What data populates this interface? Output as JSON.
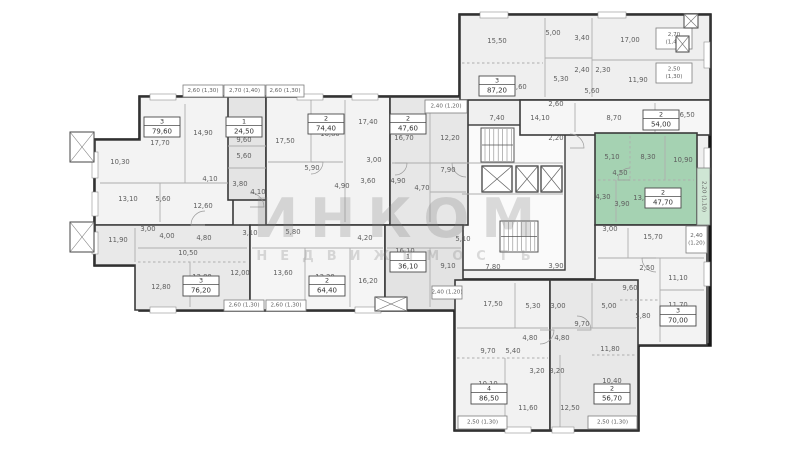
{
  "watermark": {
    "line1": "ИНКОМ",
    "line2": "НЕДВИЖИМОСТЬ"
  },
  "plan": {
    "colors": {
      "floor": "#f0f0f0",
      "wall": "#161616",
      "unit_wall": "#3a3a3a",
      "thin": "#aeaeae",
      "label": "#5f5f5f",
      "tag_border": "#4a4a4a",
      "highlight": "#a5d2b2",
      "highlight_balcony": "#cfe6d4",
      "white": "#ffffff"
    },
    "footprint": [
      [
        140,
        97,
        320,
        213
      ],
      [
        95,
        140,
        50,
        125
      ],
      [
        460,
        15,
        250,
        330
      ],
      [
        455,
        280,
        183,
        150
      ]
    ],
    "core": {
      "rect": [
        460,
        125,
        105,
        145
      ],
      "fill": "#fafafa"
    },
    "units": [
      {
        "id": "79-60",
        "type": "3",
        "area": "79,60",
        "tag": [
          162,
          127
        ],
        "fill": "#f3f3f3",
        "poly": [
          [
            140,
            97
          ],
          [
            233,
            97
          ],
          [
            233,
            225
          ],
          [
            95,
            225
          ],
          [
            95,
            140
          ],
          [
            140,
            140
          ]
        ]
      },
      {
        "id": "24-50",
        "type": "1",
        "area": "24,50",
        "tag": [
          244,
          127
        ],
        "fill": "#e4e4e4",
        "rect": [
          228,
          97,
          38,
          103
        ]
      },
      {
        "id": "74-40",
        "type": "2",
        "area": "74,40",
        "tag": [
          326,
          124
        ],
        "fill": "#f3f3f3",
        "rect": [
          266,
          97,
          124,
          128
        ]
      },
      {
        "id": "47-60",
        "type": "2",
        "area": "47,60",
        "tag": [
          408,
          124
        ],
        "fill": "#e7e7e7",
        "rect": [
          390,
          97,
          78,
          128
        ]
      },
      {
        "id": "87-20",
        "type": "3",
        "area": "87,20",
        "tag": [
          497,
          86
        ],
        "fill": "#efefef",
        "rect": [
          460,
          15,
          250,
          85
        ]
      },
      {
        "id": "54-00",
        "type": "2",
        "area": "54,00",
        "tag": [
          661,
          120
        ],
        "fill": "#f6f6f6",
        "rect": [
          520,
          100,
          190,
          35
        ]
      },
      {
        "id": "47-70",
        "type": "2",
        "area": "47,70",
        "tag": [
          663,
          198
        ],
        "fill": "#a5d2b2",
        "rect": [
          595,
          133,
          102,
          92
        ],
        "selected": true
      },
      {
        "id": "70-00",
        "type": "3",
        "area": "70,00",
        "tag": [
          678,
          316
        ],
        "fill": "#f3f3f3",
        "rect": [
          595,
          225,
          112,
          120
        ]
      },
      {
        "id": "76-20",
        "type": "3",
        "area": "76,20",
        "tag": [
          201,
          286
        ],
        "fill": "#e9e9e9",
        "poly": [
          [
            95,
            225
          ],
          [
            250,
            225
          ],
          [
            250,
            310
          ],
          [
            135,
            310
          ],
          [
            135,
            265
          ],
          [
            95,
            265
          ]
        ]
      },
      {
        "id": "64-40",
        "type": "2",
        "area": "64,40",
        "tag": [
          327,
          286
        ],
        "fill": "#f5f5f5",
        "rect": [
          250,
          225,
          135,
          85
        ]
      },
      {
        "id": "36-10",
        "type": "1",
        "area": "36,10",
        "tag": [
          408,
          262
        ],
        "fill": "#e3e3e3",
        "rect": [
          385,
          225,
          78,
          85
        ]
      },
      {
        "id": "86-50",
        "type": "4",
        "area": "86,50",
        "tag": [
          489,
          394
        ],
        "fill": "#f2f2f2",
        "rect": [
          455,
          280,
          95,
          150
        ]
      },
      {
        "id": "56-70",
        "type": "2",
        "area": "56,70",
        "tag": [
          612,
          394
        ],
        "fill": "#e8e8e8",
        "rect": [
          550,
          280,
          88,
          150
        ]
      }
    ],
    "lines": [
      [
        185,
        104,
        185,
        183,
        0
      ],
      [
        100,
        183,
        228,
        183,
        0
      ],
      [
        160,
        183,
        160,
        222,
        0
      ],
      [
        228,
        146,
        266,
        146,
        0
      ],
      [
        228,
        168,
        266,
        168,
        0
      ],
      [
        311,
        100,
        311,
        162,
        0
      ],
      [
        268,
        162,
        343,
        162,
        0
      ],
      [
        345,
        100,
        345,
        222,
        0
      ],
      [
        430,
        100,
        430,
        222,
        0
      ],
      [
        392,
        163,
        466,
        163,
        0
      ],
      [
        430,
        192,
        466,
        192,
        0
      ],
      [
        545,
        18,
        545,
        97,
        0
      ],
      [
        462,
        63,
        543,
        63,
        1
      ],
      [
        592,
        18,
        592,
        97,
        0
      ],
      [
        592,
        60,
        708,
        60,
        0
      ],
      [
        545,
        58,
        592,
        58,
        0
      ],
      [
        575,
        103,
        575,
        132,
        0
      ],
      [
        655,
        103,
        655,
        132,
        0
      ],
      [
        630,
        136,
        630,
        180,
        1
      ],
      [
        665,
        136,
        665,
        180,
        0
      ],
      [
        598,
        180,
        694,
        180,
        1
      ],
      [
        616,
        180,
        616,
        222,
        0
      ],
      [
        628,
        228,
        628,
        258,
        0
      ],
      [
        598,
        258,
        704,
        258,
        0
      ],
      [
        660,
        258,
        660,
        342,
        0
      ],
      [
        660,
        290,
        704,
        290,
        0
      ],
      [
        620,
        300,
        660,
        300,
        1
      ],
      [
        135,
        228,
        135,
        262,
        0
      ],
      [
        138,
        248,
        247,
        248,
        0
      ],
      [
        190,
        262,
        190,
        307,
        0
      ],
      [
        138,
        262,
        247,
        262,
        1
      ],
      [
        252,
        248,
        383,
        248,
        0
      ],
      [
        305,
        248,
        305,
        307,
        0
      ],
      [
        350,
        248,
        350,
        307,
        0
      ],
      [
        387,
        248,
        461,
        248,
        0
      ],
      [
        430,
        248,
        430,
        307,
        0
      ],
      [
        515,
        283,
        515,
        328,
        0
      ],
      [
        457,
        328,
        548,
        328,
        0
      ],
      [
        457,
        358,
        548,
        358,
        1
      ],
      [
        505,
        358,
        505,
        428,
        0
      ],
      [
        592,
        283,
        592,
        328,
        0
      ],
      [
        552,
        328,
        636,
        328,
        0
      ],
      [
        592,
        355,
        636,
        355,
        1
      ],
      [
        560,
        355,
        560,
        428,
        0
      ],
      [
        462,
        163,
        563,
        163,
        0
      ],
      [
        462,
        194,
        563,
        194,
        0
      ]
    ],
    "labels": [
      [
        160,
        143,
        "17,70"
      ],
      [
        203,
        133,
        "14,90"
      ],
      [
        120,
        162,
        "10,30"
      ],
      [
        128,
        199,
        "13,10"
      ],
      [
        163,
        199,
        "5,60"
      ],
      [
        203,
        206,
        "12,60"
      ],
      [
        210,
        179,
        "4,10"
      ],
      [
        244,
        140,
        "9,60"
      ],
      [
        244,
        156,
        "5,60"
      ],
      [
        240,
        184,
        "3,80"
      ],
      [
        258,
        192,
        "4,10"
      ],
      [
        285,
        141,
        "17,50"
      ],
      [
        330,
        134,
        "16,80"
      ],
      [
        368,
        122,
        "17,40"
      ],
      [
        312,
        168,
        "5,90"
      ],
      [
        374,
        160,
        "3,00"
      ],
      [
        342,
        186,
        "4,90"
      ],
      [
        368,
        181,
        "3,60"
      ],
      [
        398,
        181,
        "4,90"
      ],
      [
        422,
        188,
        "4,70"
      ],
      [
        404,
        138,
        "16,70"
      ],
      [
        450,
        138,
        "12,20"
      ],
      [
        448,
        170,
        "7,90"
      ],
      [
        118,
        240,
        "11,90"
      ],
      [
        148,
        229,
        "3,00"
      ],
      [
        167,
        236,
        "4,00"
      ],
      [
        204,
        238,
        "4,80"
      ],
      [
        250,
        233,
        "3,10"
      ],
      [
        188,
        253,
        "10,50"
      ],
      [
        161,
        287,
        "12,80"
      ],
      [
        202,
        277,
        "12,80"
      ],
      [
        240,
        273,
        "12,00"
      ],
      [
        283,
        273,
        "13,60"
      ],
      [
        325,
        277,
        "13,20"
      ],
      [
        293,
        232,
        "5,80"
      ],
      [
        365,
        238,
        "4,20"
      ],
      [
        368,
        281,
        "16,20"
      ],
      [
        405,
        251,
        "16,10"
      ],
      [
        448,
        266,
        "9,10"
      ],
      [
        463,
        239,
        "5,10"
      ],
      [
        497,
        41,
        "15,50"
      ],
      [
        553,
        33,
        "5,00"
      ],
      [
        582,
        38,
        "3,40"
      ],
      [
        630,
        40,
        "17,00"
      ],
      [
        517,
        87,
        "18,60"
      ],
      [
        582,
        70,
        "2,40"
      ],
      [
        603,
        70,
        "2,30"
      ],
      [
        638,
        80,
        "11,90"
      ],
      [
        561,
        79,
        "5,30"
      ],
      [
        592,
        91,
        "5,60"
      ],
      [
        556,
        104,
        "2,60"
      ],
      [
        497,
        118,
        "7,40"
      ],
      [
        540,
        118,
        "14,10"
      ],
      [
        614,
        118,
        "8,70"
      ],
      [
        685,
        115,
        "16,50"
      ],
      [
        612,
        157,
        "5,10"
      ],
      [
        648,
        157,
        "8,30"
      ],
      [
        683,
        160,
        "10,90"
      ],
      [
        620,
        173,
        "4,50"
      ],
      [
        603,
        197,
        "4,30"
      ],
      [
        622,
        204,
        "3,90"
      ],
      [
        643,
        198,
        "13,60"
      ],
      [
        610,
        229,
        "3,00"
      ],
      [
        653,
        237,
        "15,70"
      ],
      [
        647,
        268,
        "2,50"
      ],
      [
        678,
        278,
        "11,10"
      ],
      [
        630,
        288,
        "9,60"
      ],
      [
        678,
        305,
        "11,70"
      ],
      [
        643,
        316,
        "5,80"
      ],
      [
        556,
        138,
        "2,20"
      ],
      [
        493,
        267,
        "7,80"
      ],
      [
        556,
        266,
        "3,90"
      ],
      [
        493,
        304,
        "17,50"
      ],
      [
        533,
        306,
        "5,30"
      ],
      [
        558,
        306,
        "3,00"
      ],
      [
        609,
        306,
        "5,00"
      ],
      [
        582,
        324,
        "9,70"
      ],
      [
        530,
        338,
        "4,80"
      ],
      [
        562,
        338,
        "4,80"
      ],
      [
        513,
        351,
        "5,40"
      ],
      [
        488,
        351,
        "9,70"
      ],
      [
        610,
        349,
        "11,80"
      ],
      [
        537,
        371,
        "3,20"
      ],
      [
        557,
        371,
        "3,20"
      ],
      [
        488,
        384,
        "10,10"
      ],
      [
        612,
        381,
        "10,40"
      ],
      [
        528,
        408,
        "11,60"
      ],
      [
        570,
        408,
        "12,50"
      ]
    ],
    "balconies": [
      {
        "r": [
          183,
          85,
          40,
          12
        ],
        "lines": [
          "2,60 (1,30)"
        ]
      },
      {
        "r": [
          224,
          85,
          41,
          12
        ],
        "lines": [
          "2,70 (1,40)"
        ]
      },
      {
        "r": [
          266,
          85,
          38,
          12
        ],
        "lines": [
          "2,60 (1,30)"
        ]
      },
      {
        "r": [
          425,
          100,
          42,
          13
        ],
        "lines": [
          "2,40 (1,20)"
        ]
      },
      {
        "r": [
          656,
          28,
          36,
          21
        ],
        "lines": [
          "2,70",
          "(1,40)"
        ]
      },
      {
        "r": [
          656,
          63,
          36,
          20
        ],
        "lines": [
          "2,50",
          "(1,30)"
        ]
      },
      {
        "r": [
          697,
          168,
          13,
          57
        ],
        "lines": [
          "2,20 (1,10)"
        ],
        "vert": true,
        "green": true
      },
      {
        "r": [
          686,
          226,
          21,
          27
        ],
        "lines": [
          "2,40",
          "(1,20)"
        ]
      },
      {
        "r": [
          432,
          286,
          30,
          13
        ],
        "lines": [
          "2,40 (1,20)"
        ]
      },
      {
        "r": [
          224,
          300,
          40,
          11
        ],
        "lines": [
          "2,60 (1,30)"
        ]
      },
      {
        "r": [
          266,
          300,
          40,
          11
        ],
        "lines": [
          "2,60 (1,30)"
        ]
      },
      {
        "r": [
          458,
          416,
          49,
          13
        ],
        "lines": [
          "2,50 (1,30)"
        ]
      },
      {
        "r": [
          588,
          416,
          49,
          13
        ],
        "lines": [
          "2,50 (1,30)"
        ]
      }
    ],
    "stairs": [
      [
        481,
        128,
        33,
        34
      ],
      [
        500,
        221,
        38,
        31
      ]
    ],
    "elevators": [
      [
        482,
        166,
        30,
        26
      ],
      [
        516,
        166,
        22,
        26
      ],
      [
        541,
        166,
        21,
        26
      ]
    ],
    "xboxes": [
      [
        70,
        132,
        24,
        30
      ],
      [
        70,
        222,
        24,
        30
      ],
      [
        676,
        36,
        13,
        16
      ],
      [
        684,
        14,
        14,
        14
      ],
      [
        375,
        297,
        32,
        14
      ]
    ],
    "windows": [
      [
        150,
        94,
        26,
        6
      ],
      [
        297,
        94,
        26,
        6
      ],
      [
        352,
        94,
        26,
        6
      ],
      [
        480,
        12,
        28,
        6
      ],
      [
        598,
        12,
        28,
        6
      ],
      [
        704,
        42,
        6,
        26
      ],
      [
        704,
        148,
        6,
        26
      ],
      [
        704,
        262,
        6,
        24
      ],
      [
        92,
        152,
        6,
        26
      ],
      [
        92,
        192,
        6,
        24
      ],
      [
        92,
        232,
        6,
        22
      ],
      [
        150,
        307,
        26,
        6
      ],
      [
        355,
        307,
        26,
        6
      ],
      [
        505,
        427,
        26,
        6
      ],
      [
        552,
        427,
        22,
        6
      ]
    ],
    "arcs": [
      [
        250,
        207,
        14,
        0
      ],
      [
        311,
        162,
        12,
        1
      ],
      [
        395,
        163,
        12,
        1
      ],
      [
        466,
        163,
        14,
        2
      ],
      [
        570,
        148,
        14,
        0
      ],
      [
        630,
        180,
        12,
        3
      ],
      [
        656,
        258,
        14,
        2
      ],
      [
        540,
        330,
        14,
        1
      ],
      [
        577,
        330,
        14,
        0
      ],
      [
        205,
        225,
        14,
        3
      ]
    ]
  }
}
